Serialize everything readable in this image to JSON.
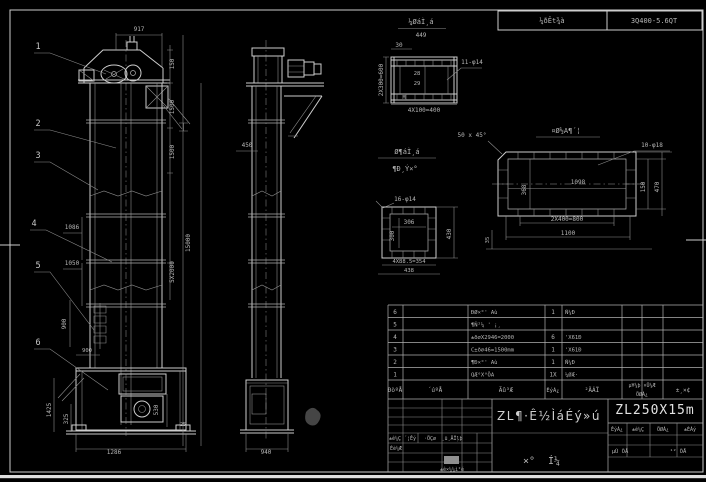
{
  "header_strip": {
    "note": "¼ðÊt¾à",
    "spec": "3Q400-5.6QT"
  },
  "channel_detail": {
    "title": "¼ØáÌ¸á",
    "scale": "449",
    "d30": "30",
    "holes": "11-φ14",
    "dleft": "2X300=600",
    "din1": "28",
    "din2": "29",
    "dm": "M",
    "d4x100": "4X100=400"
  },
  "square_detail": {
    "title1": "Ø¶áÌ¸á",
    "title2": "¶Ð¸Ý×°",
    "holes": "16-φ14",
    "d306": "306",
    "d300": "300",
    "d430": "430",
    "d4x885": "4X88.5=354",
    "d438": "438"
  },
  "flange_detail": {
    "title": "¤Ø½A¶´¦",
    "chamfer": "50 x 45°",
    "holes": "10-φ18",
    "d1098": "1098",
    "d368": "368",
    "d150": "150",
    "d470": "470",
    "d2x400": "2X400=800",
    "d1100": "1100",
    "d35": "35"
  },
  "front": {
    "d917": "917",
    "d150": "150",
    "d1500a": "1500",
    "d1500b": "1500",
    "d15000": "15000",
    "d5x2000": "5X2000",
    "d1086": "1086",
    "d1050": "1050",
    "d900v": "900",
    "d900h": "900",
    "d1425": "1425",
    "d325": "325",
    "d1286": "1286",
    "d530": "530",
    "d25": "25",
    "callouts": {
      "c1": "1",
      "c2": "2",
      "c3": "3",
      "c4": "4",
      "c5": "5",
      "c6": "6"
    }
  },
  "side": {
    "d450": "450",
    "d940": "940"
  },
  "parts_table": {
    "headers": {
      "no": "ÐòºÅ",
      "code": "´úºÅ",
      "name": "Ãû³Æ",
      "qty": "ÊýÁ¿",
      "material": "²ÄÁÏ",
      "weight_top": "µ¥¼þ ×Ü¼Æ",
      "weight_bottom": "ÖØÁ¿",
      "note": "±¸×¢"
    },
    "rows": [
      {
        "no": "6",
        "code": "",
        "name": "ÐØ×°' Aù",
        "qty": "1",
        "material": "Ñ¼Ð",
        "note": ""
      },
      {
        "no": "5",
        "code": "",
        "name": "¶Ñ²¼ ' ¡¸",
        "qty": "",
        "material": "",
        "note": ""
      },
      {
        "no": "4",
        "code": "",
        "name": "±ð∅X2946=2000",
        "qty": "6",
        "material": "'X61Ð",
        "note": ""
      },
      {
        "no": "3",
        "code": "",
        "name": "C±ð∅46=1500mm",
        "qty": "1",
        "material": "'X61Ð",
        "note": ""
      },
      {
        "no": "2",
        "code": "",
        "name": "¶Ð×°' Aù",
        "qty": "1",
        "material": "Ñ¼Ð",
        "note": ""
      },
      {
        "no": "1",
        "code": "",
        "name": "QÆ°X°ÖA",
        "qty": "1X",
        "material": "¼ØÆ·",
        "note": ""
      }
    ]
  },
  "title_block": {
    "title": "ZL¶·Ê½ÌáÉý»ú",
    "type_char1": "×°",
    "type_char2": "Í¼",
    "drawing_no": "ZL250X15m",
    "mini_headers": [
      "ÊýÁ¿",
      "±ê¼Ç",
      "ÖØÁ¿",
      "±ÈÀý"
    ],
    "sheet_left": "µÚ ÕÅ",
    "sheet_right": "¹² ÕÅ",
    "rev_labels": [
      "±ê¼Ç",
      "´¦Êý",
      "·ÖÇø",
      "¸ü¸ÄÎļþ"
    ],
    "designer": "Éè¼Æ",
    "approve": "±ê×¼¼ì²é"
  },
  "colors": {
    "background": "#000000",
    "line": "#cdcdcd",
    "dim_line": "#8e8e8e",
    "text": "#b6b6b6"
  }
}
